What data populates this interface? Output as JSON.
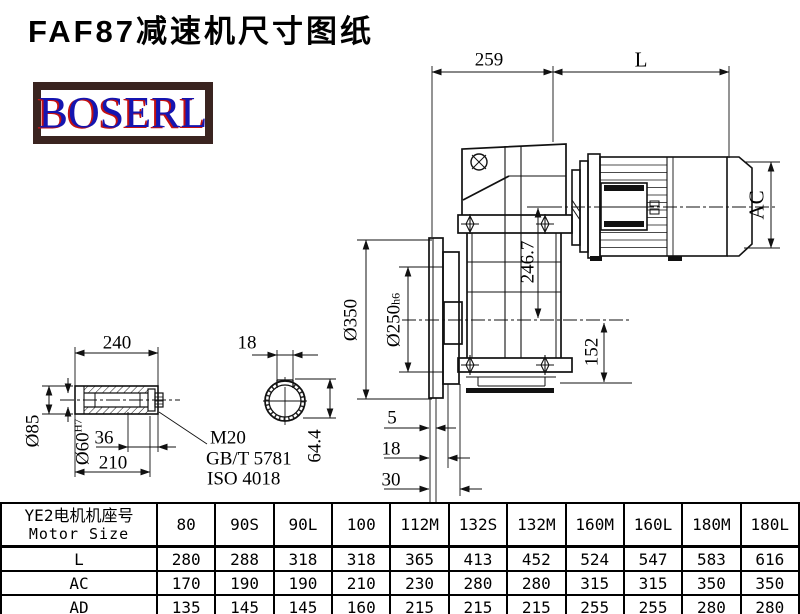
{
  "header": {
    "title": "FAF87减速机尺寸图纸",
    "logo": "BOSERL"
  },
  "drawing": {
    "dims": {
      "housing_width": "259",
      "motor_length": "L",
      "motor_diameter": "AC",
      "flange_diameter": "Ø350",
      "spigot_diameter": "Ø250",
      "spigot_tolerance": "h6",
      "input_axis_height": "246.7",
      "output_axis_height": "152",
      "flange_step1": "5",
      "flange_step2": "18",
      "flange_step3": "30",
      "shaft_length": "240",
      "shaft_outer_diameter": "Ø85",
      "bore_diameter": "Ø60",
      "bore_tolerance": "H7",
      "bolt_depth": "36",
      "hub_length": "210",
      "key_width": "18",
      "key_height": "64.4",
      "bolt_spec": "M20",
      "bolt_standard_gb": "GB/T 5781",
      "bolt_standard_iso": "ISO 4018"
    }
  },
  "table": {
    "header_cn": "YE2电机机座号",
    "header_en": "Motor Size",
    "columns": [
      "80",
      "90S",
      "90L",
      "100",
      "112M",
      "132S",
      "132M",
      "160M",
      "160L",
      "180M",
      "180L"
    ],
    "rows": [
      {
        "label": "L",
        "values": [
          "280",
          "288",
          "318",
          "318",
          "365",
          "413",
          "452",
          "524",
          "547",
          "583",
          "616"
        ]
      },
      {
        "label": "AC",
        "values": [
          "170",
          "190",
          "190",
          "210",
          "230",
          "280",
          "280",
          "315",
          "315",
          "350",
          "350"
        ]
      },
      {
        "label": "AD",
        "values": [
          "135",
          "145",
          "145",
          "160",
          "215",
          "215",
          "215",
          "255",
          "255",
          "280",
          "280"
        ]
      }
    ]
  }
}
